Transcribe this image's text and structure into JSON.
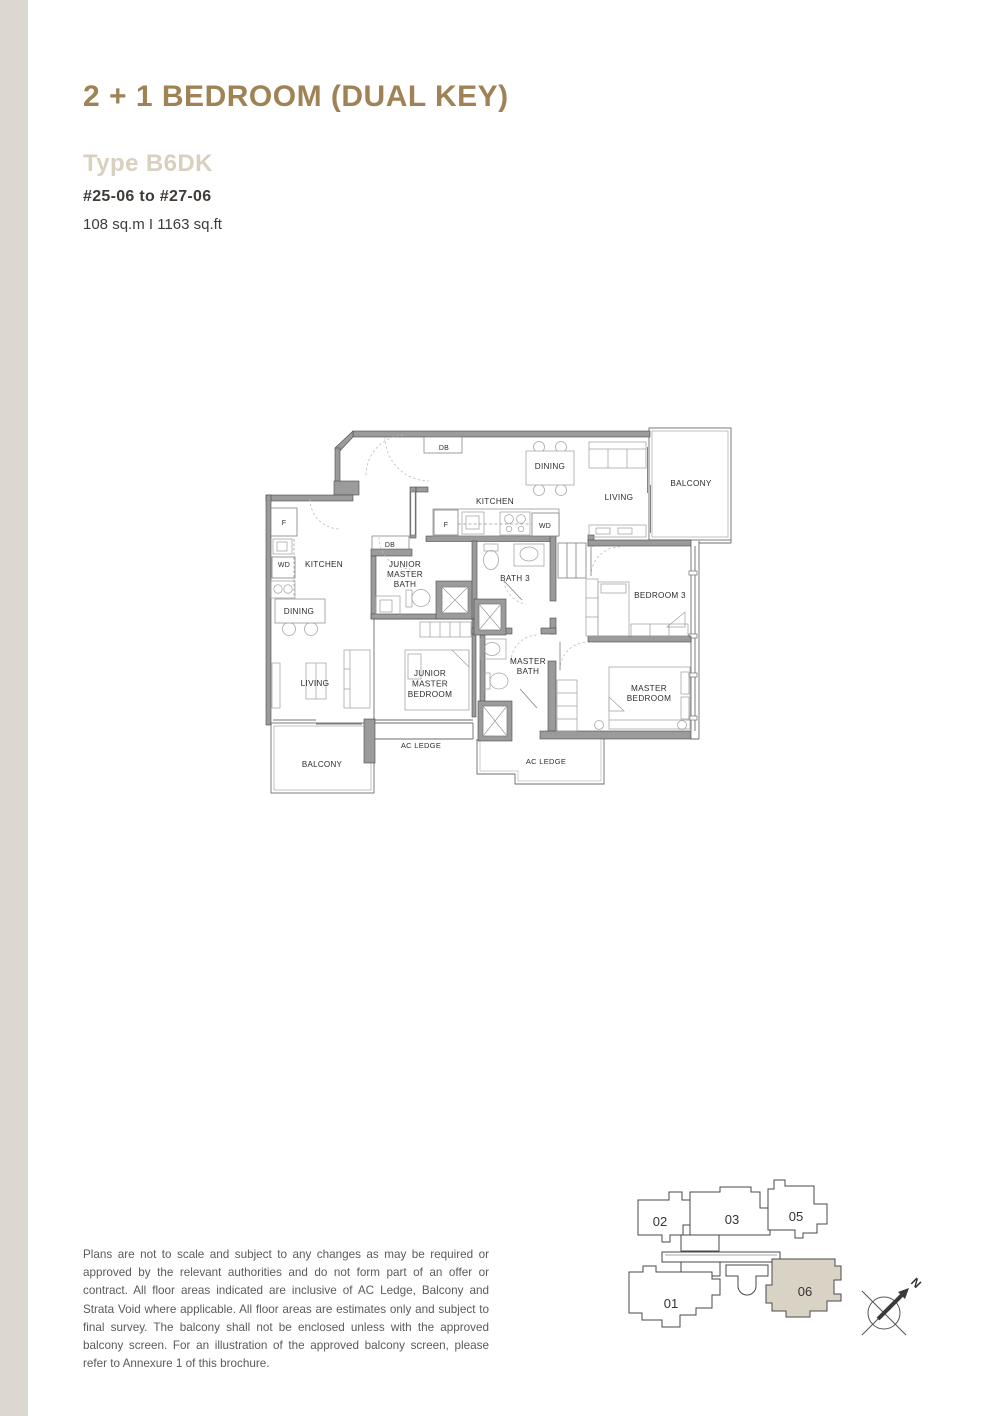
{
  "page": {
    "title": "2 + 1 BEDROOM (DUAL KEY)",
    "type_label": "Type B6DK",
    "units_range": "#25-06 to #27-06",
    "area": "108 sq.m I 1163 sq.ft"
  },
  "floorplan": {
    "labels": [
      {
        "id": "db-entry",
        "lines": [
          "DB"
        ],
        "x": 186,
        "y": 27,
        "fs": 7
      },
      {
        "id": "dining-main",
        "lines": [
          "DINING"
        ],
        "x": 292,
        "y": 46,
        "fs": 8.2
      },
      {
        "id": "living-main",
        "lines": [
          "LIVING"
        ],
        "x": 361,
        "y": 77,
        "fs": 8.2
      },
      {
        "id": "balcony-main",
        "lines": [
          "BALCONY"
        ],
        "x": 433,
        "y": 63,
        "fs": 8.2
      },
      {
        "id": "kitchen-main",
        "lines": [
          "KITCHEN"
        ],
        "x": 237,
        "y": 81,
        "fs": 8.2
      },
      {
        "id": "fridge-main",
        "lines": [
          "F"
        ],
        "x": 188,
        "y": 104,
        "fs": 7
      },
      {
        "id": "wd-main",
        "lines": [
          "WD"
        ],
        "x": 287,
        "y": 105,
        "fs": 7
      },
      {
        "id": "fridge-studio",
        "lines": [
          "F"
        ],
        "x": 26,
        "y": 102,
        "fs": 7
      },
      {
        "id": "kitchen-studio",
        "lines": [
          "KITCHEN"
        ],
        "x": 66,
        "y": 144,
        "fs": 8.2
      },
      {
        "id": "wd-studio",
        "lines": [
          "WD"
        ],
        "x": 26,
        "y": 144,
        "fs": 7
      },
      {
        "id": "db-mid",
        "lines": [
          "DB"
        ],
        "x": 132,
        "y": 124,
        "fs": 7
      },
      {
        "id": "junior-master-bath",
        "lines": [
          "JUNIOR",
          "MASTER",
          "BATH"
        ],
        "x": 147,
        "y": 144,
        "fs": 8.2,
        "lh": 10
      },
      {
        "id": "bath-3",
        "lines": [
          "BATH 3"
        ],
        "x": 257,
        "y": 158,
        "fs": 8.2
      },
      {
        "id": "bedroom-3",
        "lines": [
          "BEDROOM 3"
        ],
        "x": 402,
        "y": 175,
        "fs": 8.2
      },
      {
        "id": "dining-studio",
        "lines": [
          "DINING"
        ],
        "x": 41,
        "y": 191,
        "fs": 8.2
      },
      {
        "id": "living-studio",
        "lines": [
          "LIVING"
        ],
        "x": 57,
        "y": 263,
        "fs": 8.2
      },
      {
        "id": "junior-master-bedroom",
        "lines": [
          "JUNIOR",
          "MASTER",
          "BEDROOM"
        ],
        "x": 172,
        "y": 253,
        "fs": 8.2,
        "lh": 10.5
      },
      {
        "id": "master-bath",
        "lines": [
          "MASTER",
          "BATH"
        ],
        "x": 270,
        "y": 241,
        "fs": 8.2,
        "lh": 10
      },
      {
        "id": "master-bedroom",
        "lines": [
          "MASTER",
          "BEDROOM"
        ],
        "x": 391,
        "y": 268,
        "fs": 8.2,
        "lh": 10
      },
      {
        "id": "ac-ledge-left",
        "lines": [
          "AC LEDGE"
        ],
        "x": 163,
        "y": 325,
        "fs": 7.5
      },
      {
        "id": "balcony-studio",
        "lines": [
          "BALCONY"
        ],
        "x": 64,
        "y": 344,
        "fs": 8
      },
      {
        "id": "ac-ledge-right",
        "lines": [
          "AC LEDGE"
        ],
        "x": 288,
        "y": 341,
        "fs": 7.5
      }
    ]
  },
  "disclaimer": "Plans are not to scale and subject to any changes as may be required or approved by the relevant authorities and do not form part of an offer or contract. All floor areas indicated are inclusive of AC Ledge, Balcony and Strata Void where applicable. All floor areas are estimates only and subject to final survey. The balcony shall not be enclosed unless with the approved balcony screen. For an illustration of the approved balcony screen, please refer to Annexure 1 of this brochure.",
  "keyplan": {
    "highlighted_unit": "06",
    "units": [
      {
        "number": "02",
        "x": 38,
        "y": 51
      },
      {
        "number": "03",
        "x": 110,
        "y": 49
      },
      {
        "number": "05",
        "x": 174,
        "y": 46
      },
      {
        "number": "01",
        "x": 49,
        "y": 133
      },
      {
        "number": "06",
        "x": 183,
        "y": 121
      }
    ],
    "north_label": "N"
  },
  "colors": {
    "accent": "#9f8255",
    "type_label": "#d9d0c0",
    "stripe": "#dcd8d0",
    "wall": "#9b9b9b",
    "keyplan_highlight": "#d9d3c5"
  }
}
